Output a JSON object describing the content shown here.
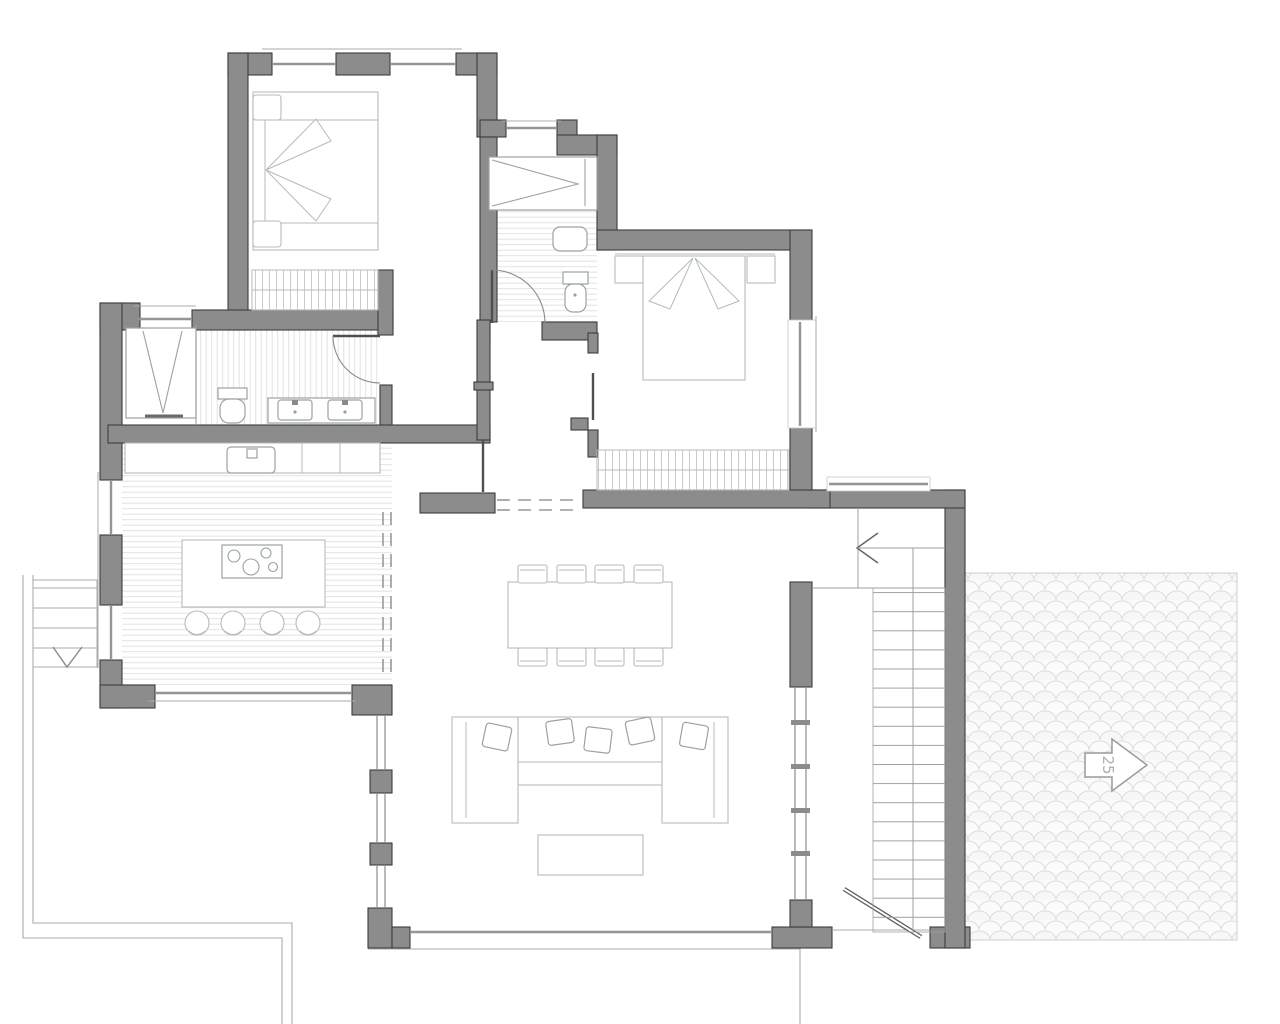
{
  "colors": {
    "background": "#ffffff",
    "wall_fill": "#8c8c8c",
    "wall_outline": "#3c3c3c",
    "furniture_line": "#b5bbbb",
    "fixture_line": "#9aa2a2",
    "hatch_line": "#e2e2e2",
    "closet_hatch_line": "#c8cccc",
    "door_line": "#4f4f4f",
    "door_arc": "#8a8a8a",
    "dashed_line": "#9a9a9a",
    "site_line": "#ababab",
    "glass_line": "#8f9797",
    "patio_pattern": "#dcdcdc"
  },
  "patio": {
    "direction_arrow_label": "25"
  }
}
